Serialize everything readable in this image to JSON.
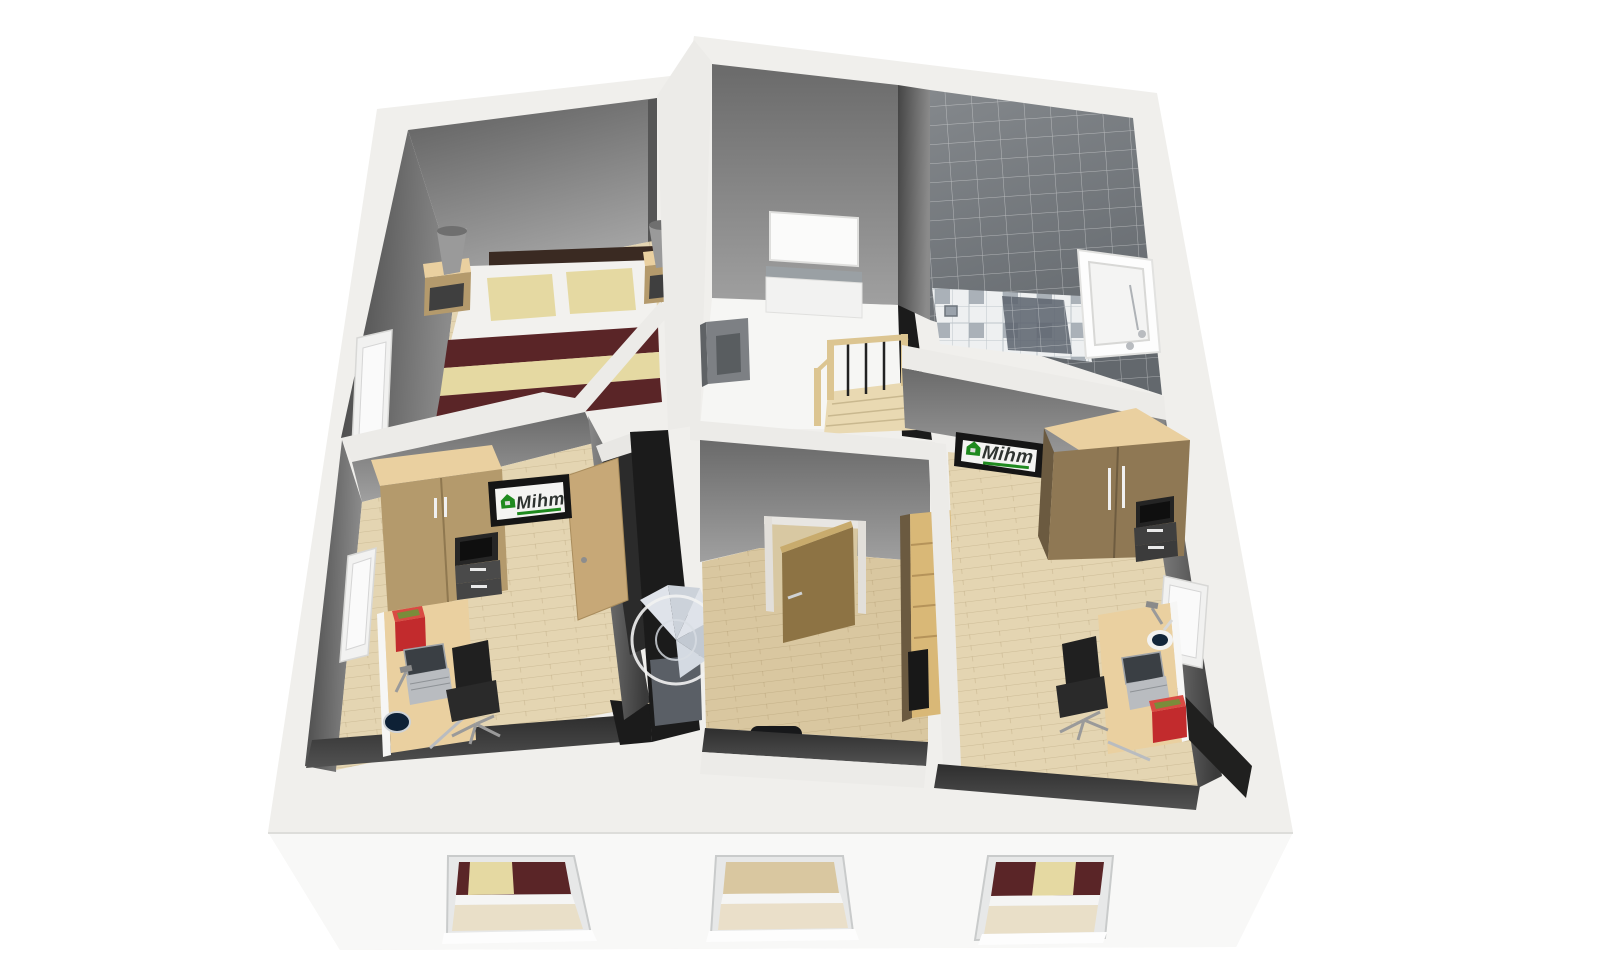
{
  "scene": {
    "kind": "floorplan-3d-cutaway-render",
    "storey": "upper-floor",
    "view": "birds-eye-dollhouse"
  },
  "branding": {
    "logo_text": "Mihm",
    "logo_text_color": "#2e3330",
    "logo_accent_green": "#1f8a1f",
    "logo_frame": "#151515",
    "logo_screen": "#f4f4f2",
    "instances": [
      "office-left-wall-screen",
      "office-right-wall-sign"
    ]
  },
  "palette": {
    "background": "#ffffff",
    "shell_top": "#f0efec",
    "shell_face": "#f8f8f7",
    "wall_cut_band": "#ecebe8",
    "wall_black": "#1b1b1b",
    "floor_wood": "#e4d5b2",
    "floor_wood_deep": "#d9c7a0",
    "floor_pale": "#f6f6f4",
    "tile_floor_dark": "#5e6570",
    "bed_linen": "#f2f1ee",
    "blanket_maroon": "#5a2527",
    "pillow_beige": "#e5d9a2",
    "wood_furniture": "#b49a6c",
    "wood_furniture_top": "#ead0a0",
    "wood_door": "#8d7344",
    "box_red": "#c22b2d",
    "chair_black": "#202020",
    "metal_silver": "#b9bcc0",
    "lamp_grey": "#9a9a9a",
    "railing_wood": "#dcc591"
  },
  "rooms": [
    {
      "id": "bedroom",
      "items": [
        "double-bed",
        "nightstand-left",
        "nightstand-right",
        "table-lamp-left",
        "table-lamp-right",
        "west-window"
      ]
    },
    {
      "id": "office-left",
      "items": [
        "wardrobe",
        "wall-screen-mihm",
        "open-door",
        "desk",
        "laptop",
        "desk-lamp",
        "desk-bowl",
        "red-box",
        "office-chair",
        "west-window"
      ]
    },
    {
      "id": "hallway",
      "items": [
        "mirror-panel",
        "sideboard",
        "wall-cabinet",
        "staircase",
        "railing"
      ]
    },
    {
      "id": "bathroom",
      "items": [
        "bathtub",
        "shower-area",
        "tiled-walls",
        "floor-drain"
      ]
    },
    {
      "id": "middle-room",
      "items": [
        "open-door",
        "shelf-unit",
        "chair-partial"
      ]
    },
    {
      "id": "office-right",
      "items": [
        "wardrobe",
        "wall-sign-mihm",
        "desk",
        "laptop",
        "desk-lamp",
        "mug",
        "red-box",
        "office-chair",
        "east-window"
      ]
    },
    {
      "id": "stair-core",
      "items": [
        "spiral-staircase"
      ]
    },
    {
      "id": "facade",
      "items": [
        "window-1-bed-view",
        "window-2-floor-view",
        "window-3-bed-view"
      ]
    }
  ]
}
